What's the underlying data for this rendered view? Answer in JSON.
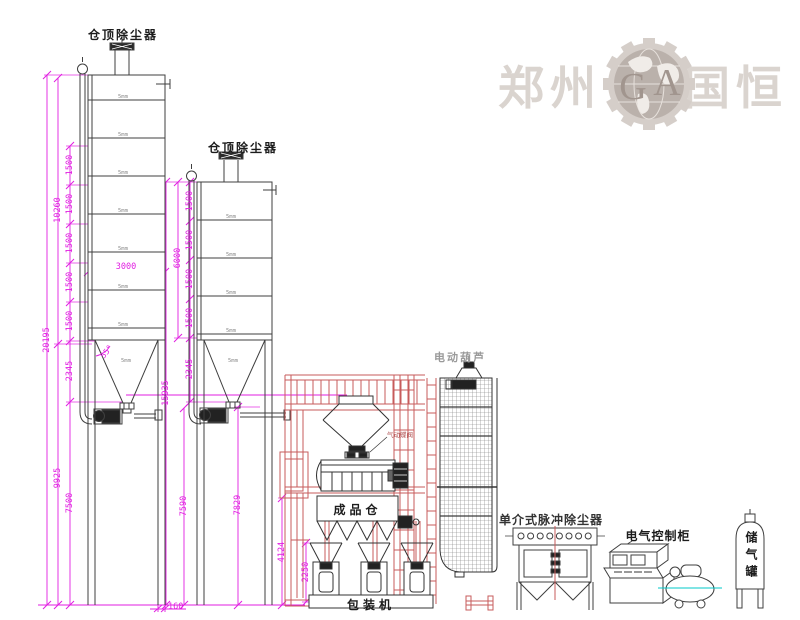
{
  "watermark": {
    "city": "郑州",
    "name": "国恒",
    "monogram_g": "G",
    "monogram_a": "A"
  },
  "silo1": {
    "top_label": "仓顶除尘器",
    "dims": {
      "overall": "20195",
      "upper": "10260",
      "lower": "9925",
      "segments": [
        "1500",
        "1500",
        "1500",
        "1500",
        "1500"
      ],
      "hopper": "2345",
      "legs": "7500",
      "diameter": "3000",
      "hopper_angle": "55°",
      "leg_width": "160"
    }
  },
  "silo2": {
    "top_label": "仓顶除尘器",
    "dims": {
      "overall": "15935",
      "body": "6000",
      "segments": [
        "1500",
        "1500",
        "1500",
        "1500"
      ],
      "hopper": "2345",
      "legs": "7590",
      "discharge_height": "7829"
    }
  },
  "tower": {
    "valve_label": "气动蝶阀",
    "product_bin_label": "成品仓",
    "packer_label": "包装机",
    "dims": {
      "platform": "4124",
      "packer": "2250"
    }
  },
  "elevator": {
    "hoist_label": "电动葫芦"
  },
  "dust_collector": {
    "label": "单介式脉冲除尘器"
  },
  "control_cabinet": {
    "label": "电气控制柜"
  },
  "air_tank": {
    "label": "储气罐"
  },
  "marks": {
    "plate": "5mm"
  },
  "colors": {
    "dimension": "#e11ee1",
    "structure_red": "#c75b5b",
    "line": "#3f3f3f",
    "watermark": "#d9d2cd",
    "centerline_cyan": "#00c8c8",
    "hoist_gray": "#9a9a9a"
  }
}
